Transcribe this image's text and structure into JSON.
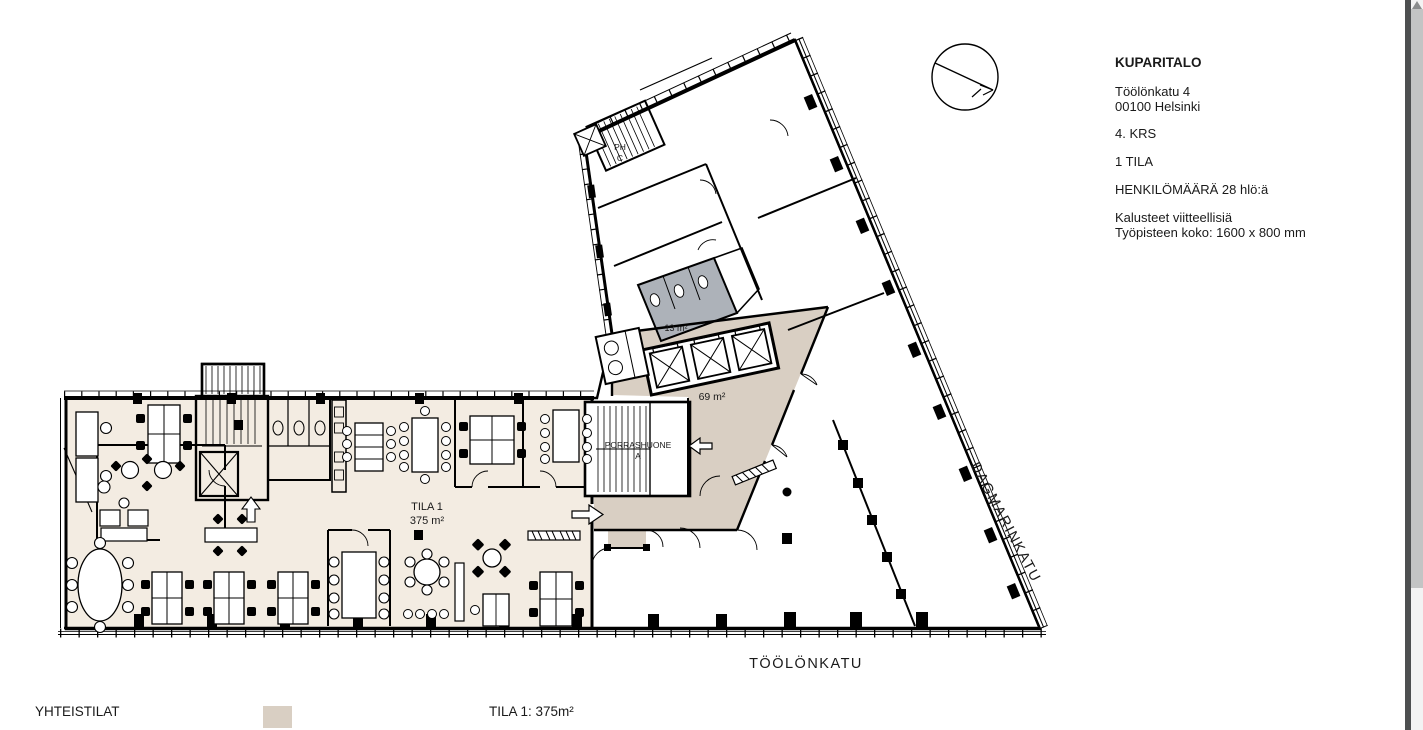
{
  "title_block": {
    "name": "KUPARITALO",
    "address_line1": "Töölönkatu 4",
    "address_line2": "00100 Helsinki",
    "floor": "4. KRS",
    "spaces": "1 TILA",
    "capacity": "HENKILÖMÄÄRÄ 28 hlö:ä",
    "note1": "Kalusteet viitteellisiä",
    "note2": "Työpisteen koko: 1600 x 800 mm"
  },
  "plan": {
    "tila1_label": "TILA 1",
    "tila1_area": "375 m²",
    "lobby_area": "69 m²",
    "wc_area": "13 m²",
    "stairwell_a_line1": "PORRASHUONE",
    "stairwell_a_line2": "A",
    "stairwell_c_line1": "PH",
    "stairwell_c_line2": "C"
  },
  "streets": {
    "south": "TÖÖLÖNKATU",
    "east": "DAGMARINKATU"
  },
  "legend": {
    "shared_spaces_label": "YHTEISTILAT",
    "tila1_summary": "TILA 1: 375m²"
  },
  "colors": {
    "tila1_fill": "#f3ece2",
    "common_fill": "#d9cfc3",
    "wc_fill": "#adb2b9",
    "wall": "#000000"
  }
}
